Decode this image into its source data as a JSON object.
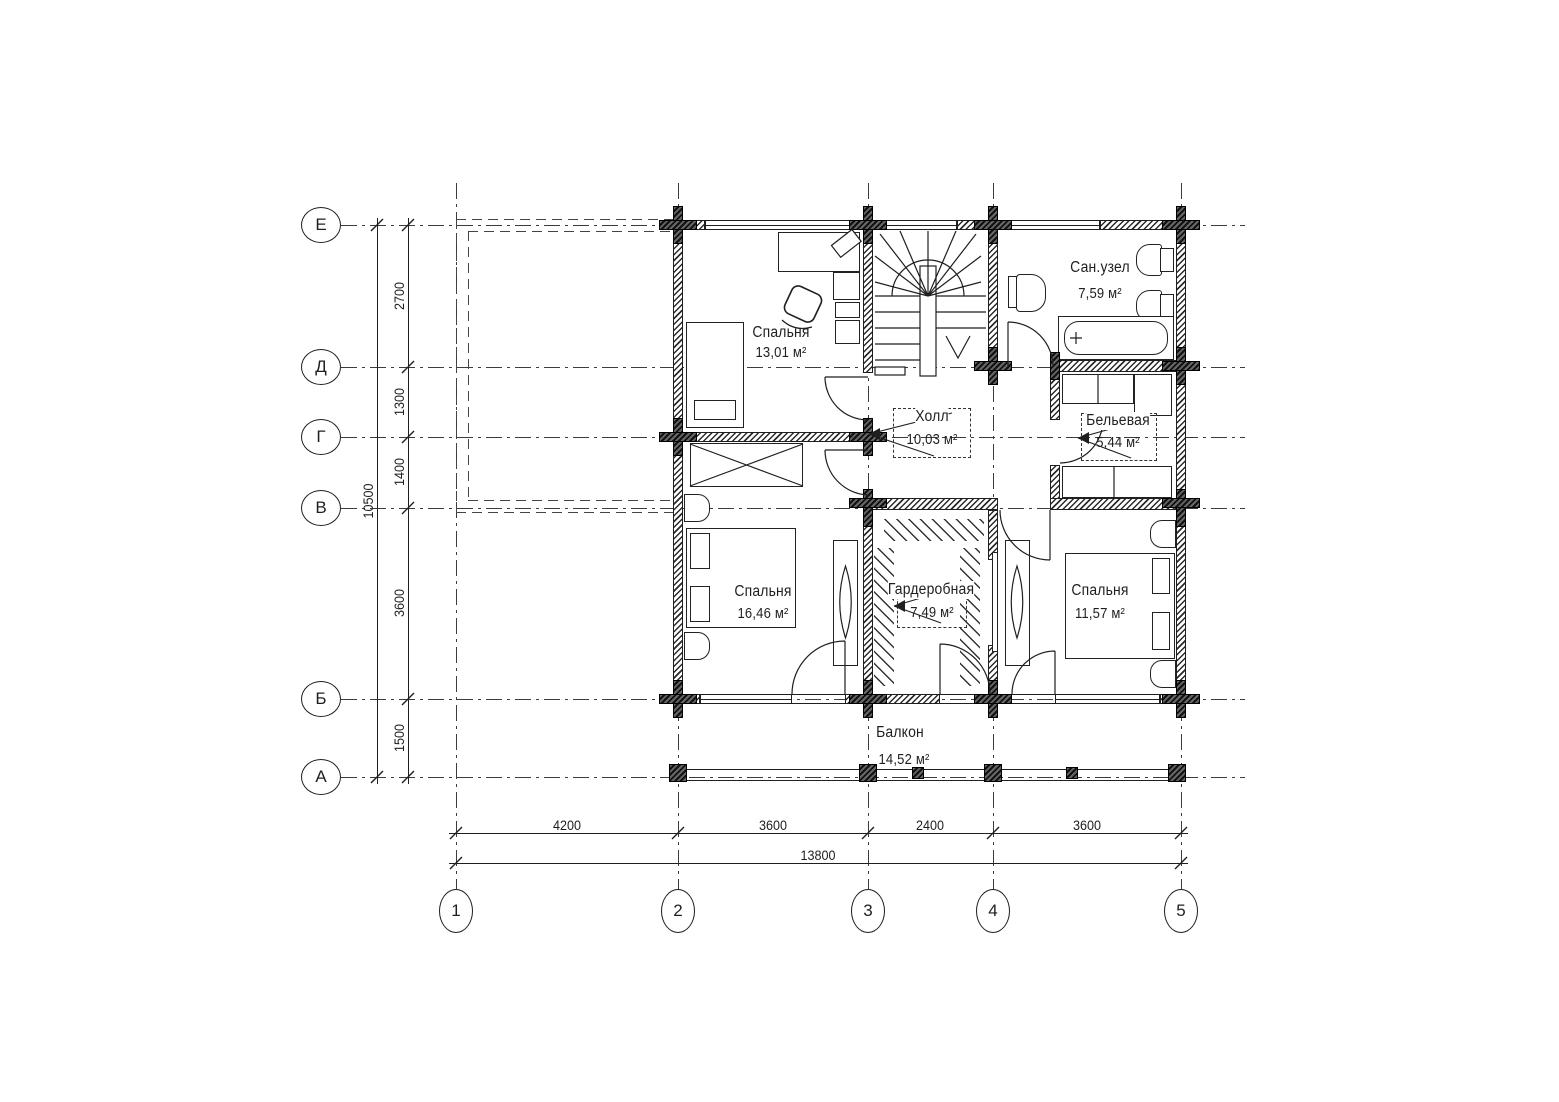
{
  "axes": {
    "vertical": [
      "Е",
      "Д",
      "Г",
      "В",
      "Б",
      "А"
    ],
    "horizontal": [
      "1",
      "2",
      "3",
      "4",
      "5"
    ]
  },
  "rooms": [
    {
      "name": "Спальня",
      "area": "13,01 м²"
    },
    {
      "name": "Сан.узел",
      "area": "7,59 м²"
    },
    {
      "name": "Холл",
      "area": "10,03 м²"
    },
    {
      "name": "Бельевая",
      "area": "5,44 м²"
    },
    {
      "name": "Спальня",
      "area": "16,46 м²"
    },
    {
      "name": "Гардеробная",
      "area": "7,49 м²"
    },
    {
      "name": "Спальня",
      "area": "11,57 м²"
    },
    {
      "name": "Балкон",
      "area": "14,52 м²"
    }
  ],
  "dims": {
    "left_segments": [
      "2700",
      "1300",
      "1400",
      "3600",
      "1500"
    ],
    "left_total": "10500",
    "bottom_segments": [
      "4200",
      "3600",
      "2400",
      "3600"
    ],
    "bottom_total": "13800"
  },
  "colors": {
    "line": "#1f1f1f",
    "background": "#ffffff"
  }
}
